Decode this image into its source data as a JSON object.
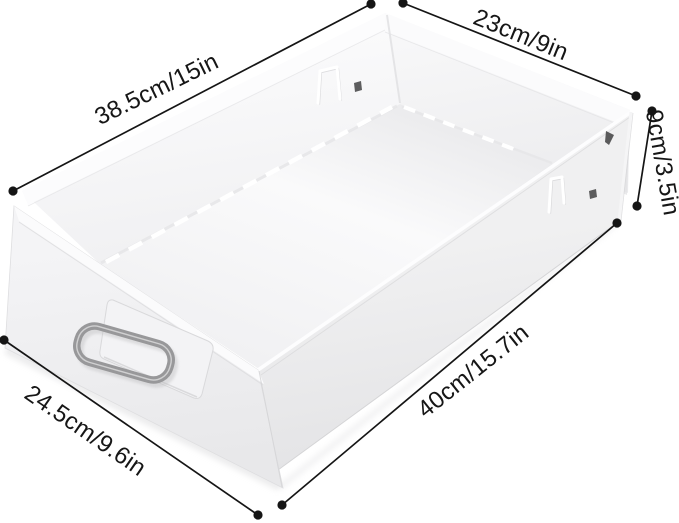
{
  "dimensions": {
    "top_length": "38.5cm/15in",
    "top_width": "23cm/9in",
    "side_height": "9cm/3.5in",
    "bottom_length": "40cm/15.7in",
    "front_width": "24.5cm/9.6in"
  },
  "colors": {
    "background": "#ffffff",
    "dimension_line": "#151515",
    "dimension_text": "#161616",
    "drawer_body": "#f2f2f4",
    "handle_metal": "#c7c7c9"
  }
}
